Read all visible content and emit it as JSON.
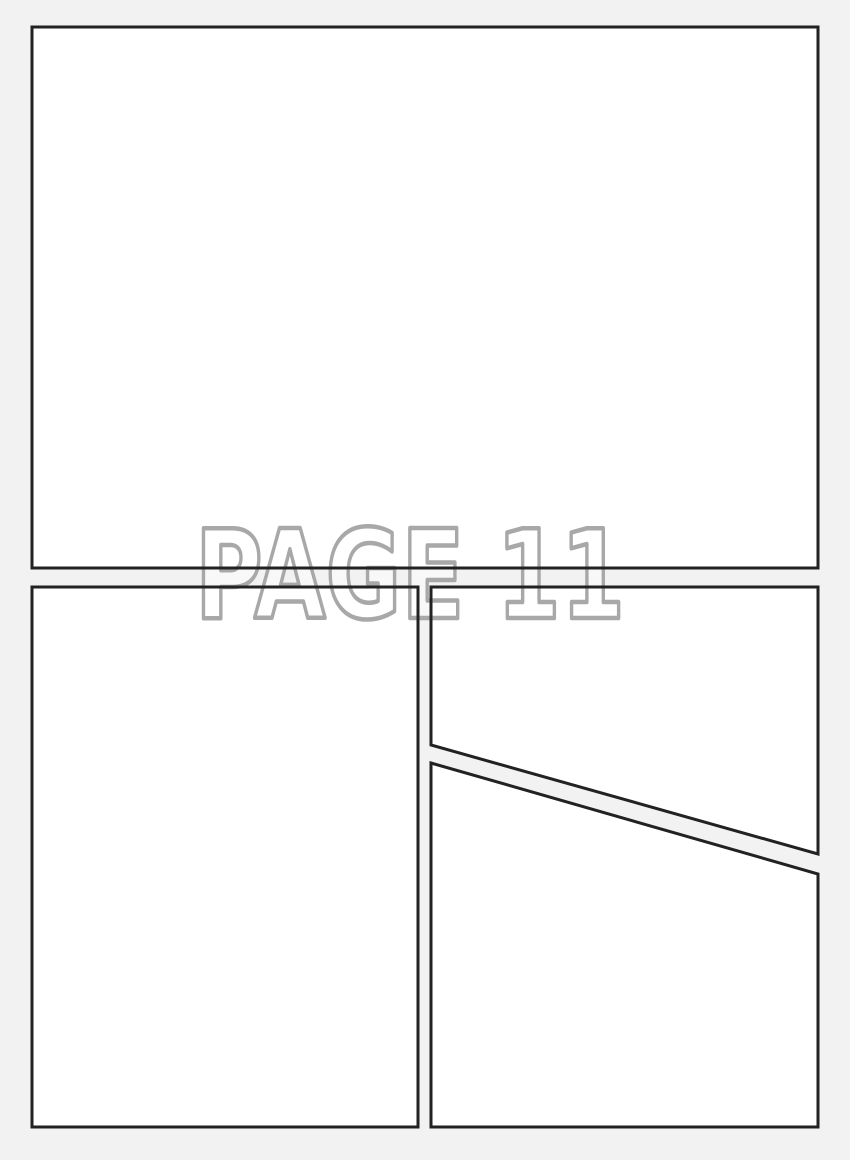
{
  "watermark": {
    "text": "PAGE 11"
  },
  "colors": {
    "background": "#f2f2f2",
    "panel_fill": "#ffffff",
    "panel_border": "#222222",
    "watermark_stroke": "#a8a8a8",
    "watermark_fill": "rgba(255,255,255,0.45)"
  },
  "canvas": {
    "width": 850,
    "height": 1160
  },
  "panels": [
    {
      "id": "panel-1",
      "label": "top full-width panel",
      "points": [
        [
          32,
          27
        ],
        [
          818,
          27
        ],
        [
          818,
          568
        ],
        [
          32,
          568
        ]
      ]
    },
    {
      "id": "panel-2",
      "label": "bottom-left tall panel",
      "points": [
        [
          32,
          587
        ],
        [
          418,
          587
        ],
        [
          418,
          1127
        ],
        [
          32,
          1127
        ]
      ]
    },
    {
      "id": "panel-3",
      "label": "right upper diagonal panel",
      "points": [
        [
          431,
          587
        ],
        [
          818,
          587
        ],
        [
          818,
          854
        ],
        [
          431,
          745
        ]
      ]
    },
    {
      "id": "panel-4",
      "label": "right lower diagonal panel",
      "points": [
        [
          431,
          763
        ],
        [
          818,
          874
        ],
        [
          818,
          1127
        ],
        [
          431,
          1127
        ]
      ]
    }
  ]
}
